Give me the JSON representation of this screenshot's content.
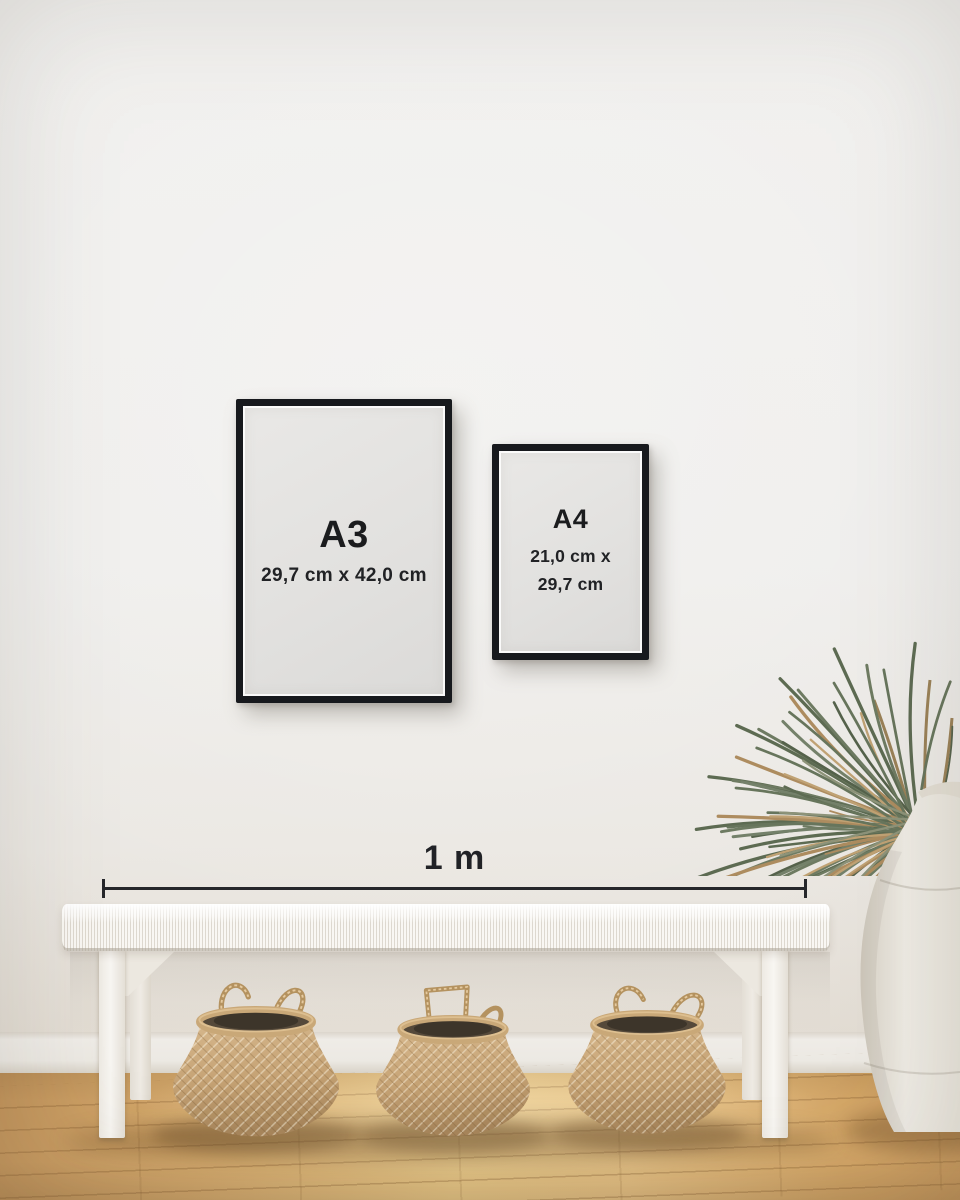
{
  "frames": [
    {
      "label": "A3",
      "dimensions": "29,7 cm x 42,0 cm"
    },
    {
      "label": "A4",
      "dimensions_line1": "21,0 cm x",
      "dimensions_line2": "29,7 cm"
    }
  ],
  "ruler": {
    "label": "1 m"
  },
  "colors": {
    "frame_border": "#17191d",
    "frame_paper": "#e4e3e1",
    "label_text": "#1b1c1e",
    "ruler": "#26272b",
    "wall": "#efeeec",
    "baseboard": "#edeae4",
    "floor_light": "#eac988",
    "floor_dark": "#c2945b",
    "bench_white": "#f5f3ef",
    "basket_tan": "#c5a276",
    "vase_cream": "#eae5dc",
    "leaf_green": "#5c6b51",
    "leaf_brown": "#ad8c5f"
  }
}
